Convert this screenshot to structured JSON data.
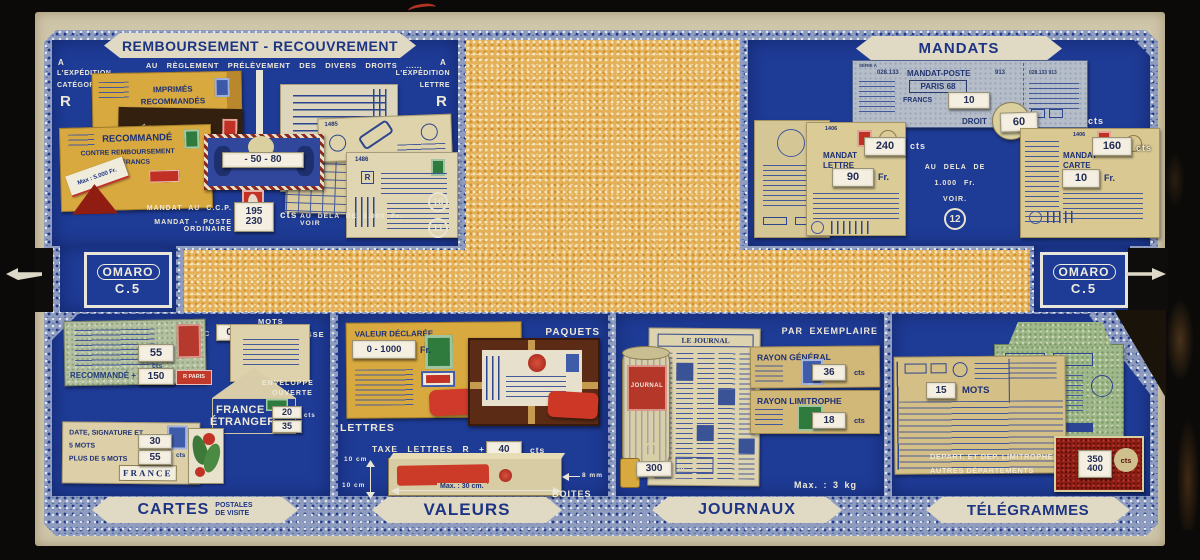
{
  "u": {
    "cts": "cts",
    "fr": "Fr.",
    "r": "R"
  },
  "brand": {
    "logo": "OMARO",
    "model": "C.5"
  },
  "remb": {
    "title": "REMBOURSEMENT - RECOUVREMENT",
    "subtitle": "AU RÈGLEMENT PRÉLÈVEMENT DES DIVERS DROITS ......",
    "a_left": "A",
    "exp_left": "L'EXPÉDITION",
    "cat_left": "CATÉGORIE",
    "a_right": "A",
    "exp_right": "L'EXPÉDITION",
    "lettre_right": "LETTRE",
    "imprimes1": "IMPRIMÉS",
    "imprimes2": "RECOMMANDÉS",
    "echant1": "ÉCHANTILLONS",
    "echant2": "RECOMMANDÉS",
    "recommande": "RECOMMANDÉ",
    "contre": "CONTRE REMBOURSEMENT",
    "francs": "FRANCS",
    "max": "Max : 5.000 Fr.",
    "stamp_win": "- 50 - 80",
    "f1485": "1485",
    "f1486": "1486",
    "ccp1": "MANDAT AU C.C.P.",
    "ccp2": "MANDAT - POSTE ORDINAIRE",
    "v1": "195",
    "v2": "230",
    "note": "AU DELA DE 1.000 Fr. VOIR",
    "ref1": "10",
    "ref2": "11"
  },
  "mandats": {
    "title": "MANDATS",
    "serie": "SÉRIE A",
    "n1": "028.133",
    "poste": "MANDAT-POSTE",
    "n2": "913",
    "ville": "PARIS 68",
    "francs": "FRANCS",
    "francs_v": "10",
    "stub": "028.133 913",
    "droit": "DROIT",
    "droit_v": "60",
    "f1406a": "1406",
    "lettre1": "MANDAT",
    "lettre2": "LETTRE",
    "lettre_cts": "240",
    "lettre_fr": "90",
    "note1": "AU DELA DE",
    "note2": "1.000 Fr.",
    "note3": "VOIR.",
    "ref": "12",
    "f1406b": "1406",
    "carte1": "MANDAT",
    "carte2": "CARTE",
    "carte_cts": "160",
    "carte_fr": "10"
  },
  "cartes": {
    "avec": "AVEC",
    "pol_v": "0 ★",
    "mots": "MOTS",
    "pol": "DE POLITESSE",
    "v55": "55",
    "recom": "RECOMMANDÉ +",
    "v150": "150",
    "rlabel": "R PARIS",
    "env1": "ENVELOPPE",
    "env2": "OUVERTE",
    "france": "FRANCE",
    "etranger": "ÉTRANGER",
    "v20": "20",
    "v35": "35",
    "date": "DATE, SIGNATURE ET",
    "mots5": "5 MOTS",
    "v30": "30",
    "plus5": "PLUS DE 5 MOTS",
    "v55b": "55",
    "france2": "FRANCE",
    "footer": "CARTES",
    "fsub1": "POSTALES",
    "fsub2": "DE VISITE"
  },
  "valeurs": {
    "vd": "VALEUR DÉCLARÉE",
    "vd_v": "0 - 1000",
    "paquets": "PAQUETS",
    "lettres": "LETTRES",
    "taxe": "TAXE LETTRES R +",
    "taxe_v": "40",
    "d1": "10 cm",
    "d2": "10 cm",
    "dmax": "Max. : 30 cm.",
    "d3": "8 mm",
    "boites": "BOITES",
    "footer": "VALEURS"
  },
  "journaux": {
    "titre": "LE JOURNAL",
    "roll": "JOURNAL",
    "parex": "PAR EXEMPLAIRE",
    "rg": "RAYON GÉNÉRAL",
    "rg_v": "36",
    "rl": "RAYON LIMITROPHE",
    "rl_v": "18",
    "poids": "300",
    "gr": "gr",
    "max": "Max. : 3 kg",
    "footer": "JOURNAUX"
  },
  "tele": {
    "v15": "15",
    "mots": "MOTS",
    "dep1": "DEPART. ET DEP. LIMITROPHES",
    "dep2": "AUTRES DÉPARTEMENTS",
    "v350": "350",
    "v400": "400",
    "footer": "TÉLÉGRAMMES"
  }
}
